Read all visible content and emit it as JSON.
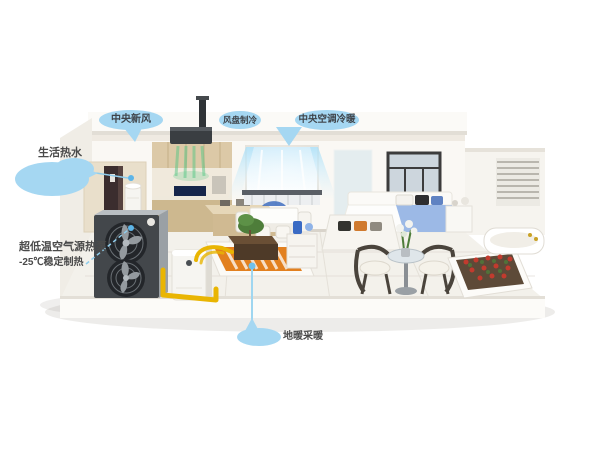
{
  "callouts": {
    "fresh_air": "中央新风",
    "fan_coil_cooling": "风盘制冷",
    "central_ac": "中央空调冷暖",
    "hot_water": "生活热水",
    "heat_pump_line1": "超低温空气源热泵",
    "heat_pump_line2": "-25℃稳定制热",
    "floor_heating": "地暖采暖"
  },
  "colors": {
    "callout_bubble": "#a5d7f2",
    "callout_text": "#3f444a",
    "leader_line": "#8fcdec",
    "heat_pump_front": "#43474b",
    "pipe_yellow": "#e9b502",
    "floor_coil_orange": "#e2801f",
    "cool_airflow": "#9fdcf5",
    "fresh_airflow": "#57c785",
    "blanket_blue": "#9cb9e6",
    "planter_flowers": "#c23b2e"
  }
}
